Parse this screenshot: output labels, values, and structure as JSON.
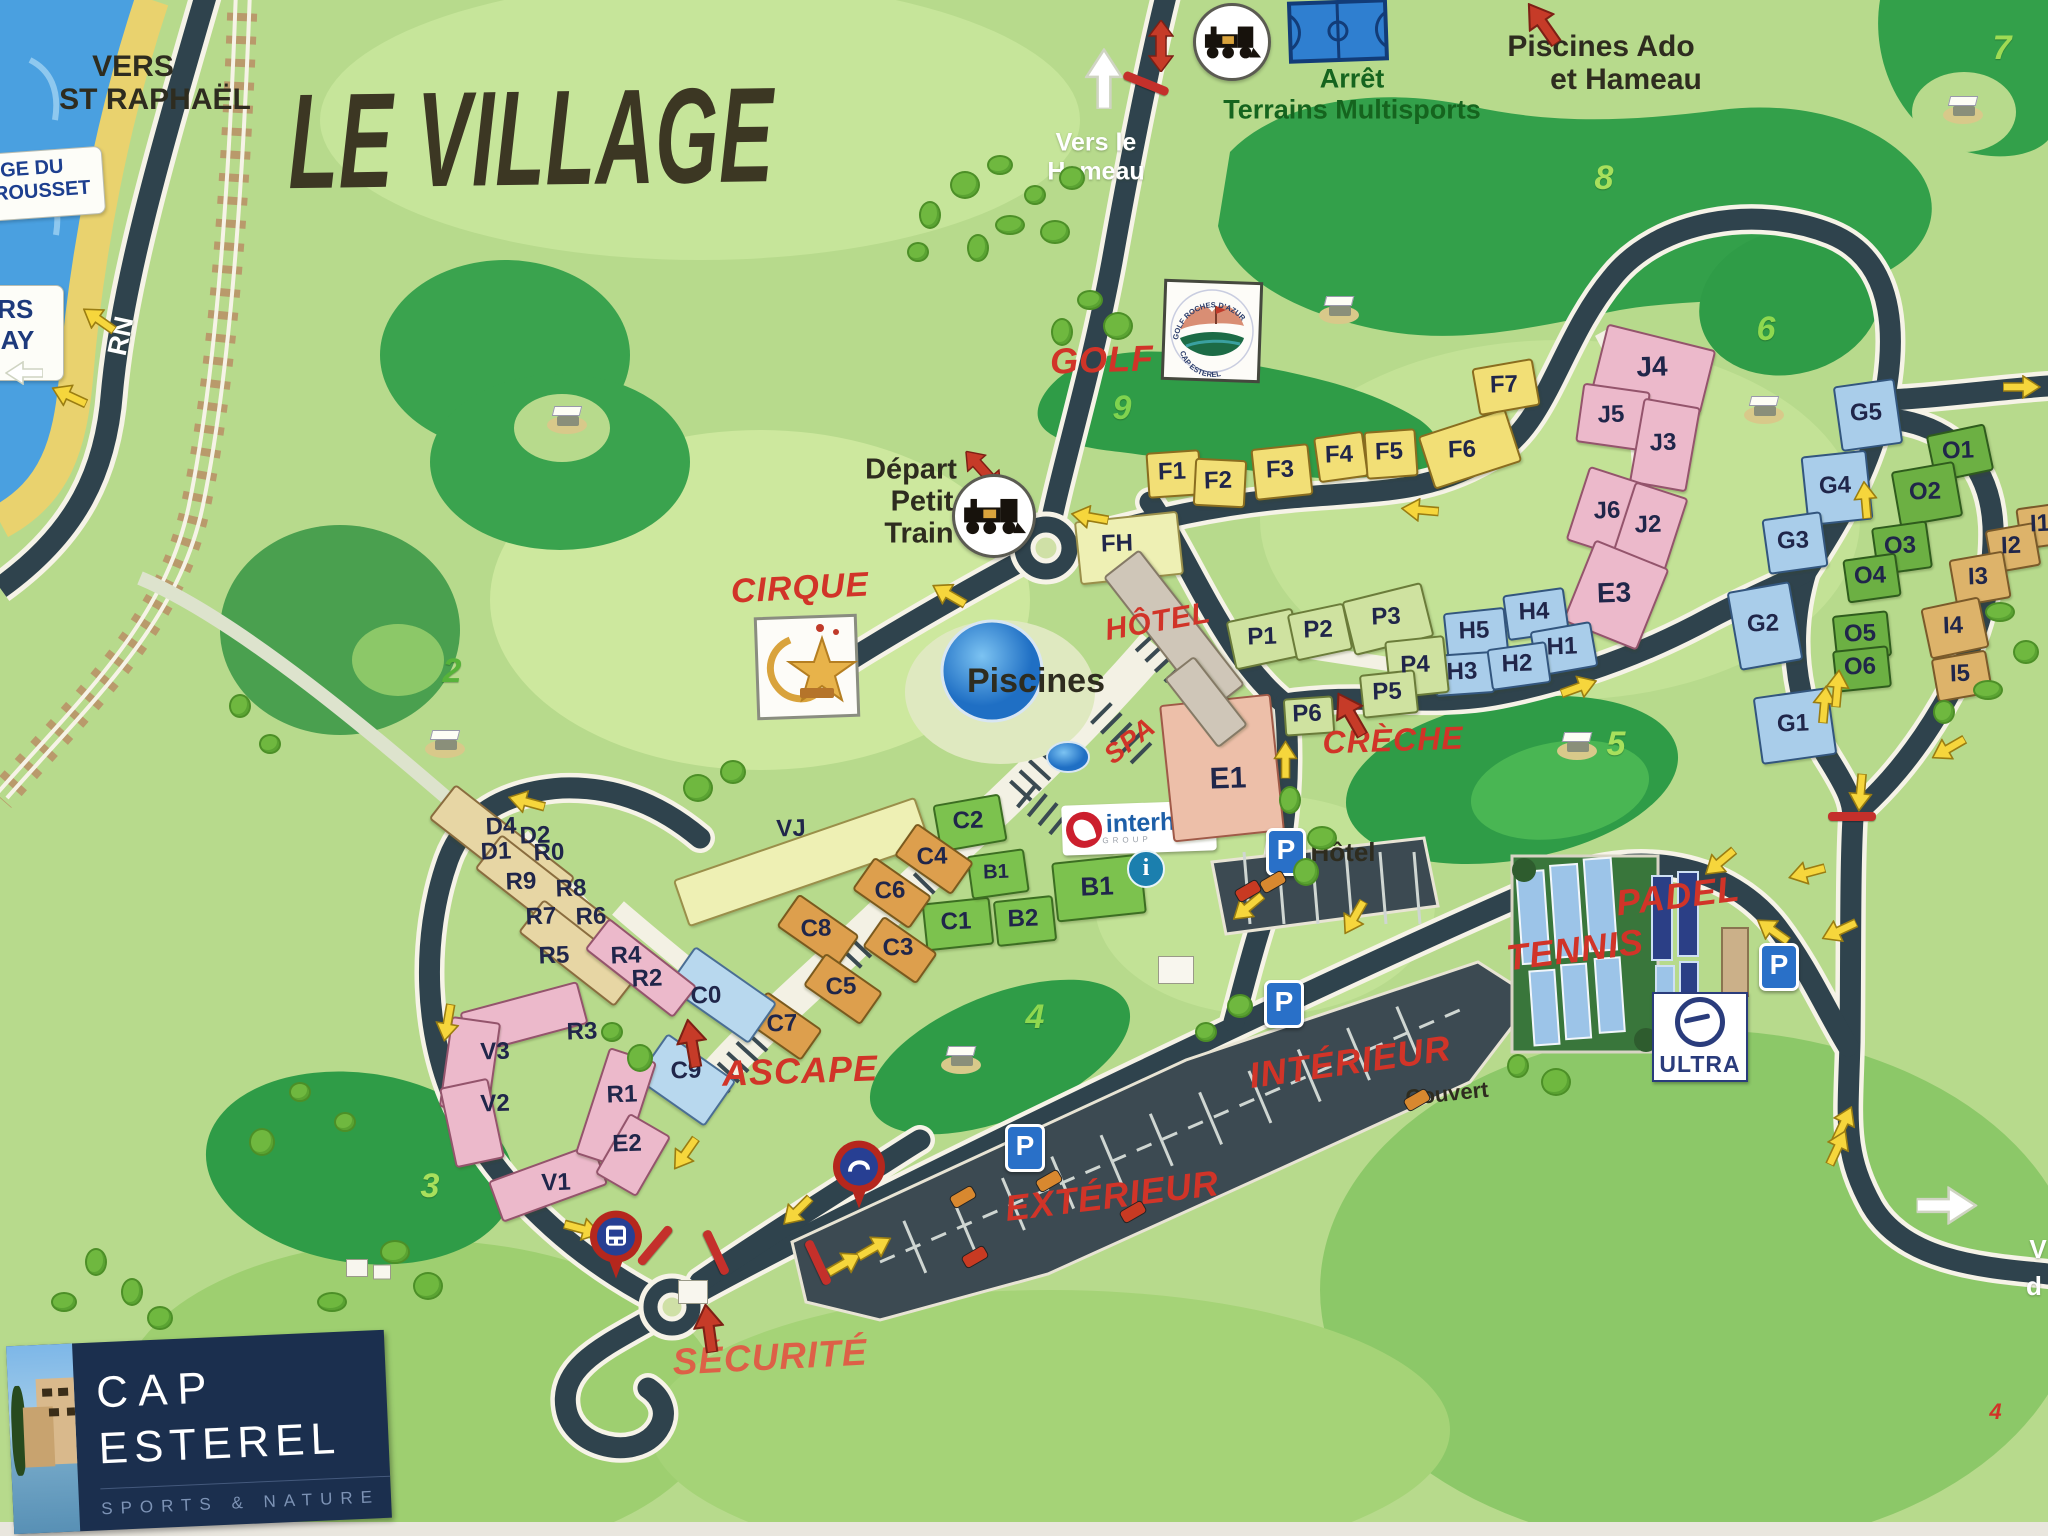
{
  "title": "LE VILLAGE",
  "cap_logo": {
    "l1": "CAP",
    "l2": "ESTEREL",
    "tag": "SPORTS & NATURE"
  },
  "signs": {
    "plage": {
      "l1": "PLAGE DU",
      "l2": "POURROUSSET"
    },
    "agay": {
      "l1": "VERS",
      "l2": "AGAY"
    }
  },
  "logos": {
    "interhome": {
      "text": "interhome",
      "sub": "GROUP"
    },
    "ultra": {
      "text": "ULTRA"
    },
    "golf_badge": {
      "top": "GOLF ROCHES D'AZUR",
      "bottom": "CAP ESTEREL"
    }
  },
  "red_labels": [
    {
      "t": "GOLF",
      "x": 1102,
      "y": 360,
      "s": 36,
      "r": -2
    },
    {
      "t": "CIRQUE",
      "x": 800,
      "y": 588,
      "s": 34,
      "r": -3
    },
    {
      "t": "HÔTEL",
      "x": 1158,
      "y": 622,
      "s": 30,
      "r": -10
    },
    {
      "t": "SPA",
      "x": 1130,
      "y": 741,
      "s": 27,
      "r": -38
    },
    {
      "t": "CRÈCHE",
      "x": 1393,
      "y": 740,
      "s": 32,
      "r": -2
    },
    {
      "t": "ASCAPE",
      "x": 800,
      "y": 1071,
      "s": 36,
      "r": -2
    },
    {
      "t": "TENNIS",
      "x": 1575,
      "y": 950,
      "s": 36,
      "r": -7
    },
    {
      "t": "PADEL",
      "x": 1678,
      "y": 896,
      "s": 36,
      "r": -7
    },
    {
      "t": "INTÉRIEUR",
      "x": 1350,
      "y": 1062,
      "s": 36,
      "r": -8
    },
    {
      "t": "EXTÉRIEUR",
      "x": 1112,
      "y": 1196,
      "s": 36,
      "r": -7
    },
    {
      "t": "SÉCURITÉ",
      "x": 770,
      "y": 1357,
      "s": 37,
      "r": -3,
      "c": "#dd6047"
    },
    {
      "t": "4",
      "x": 1996,
      "y": 1412,
      "s": 22,
      "r": 0
    }
  ],
  "dark_labels": [
    {
      "t": "VERS",
      "x": 133,
      "y": 67,
      "s": 30
    },
    {
      "t": "ST RAPHAËL",
      "x": 155,
      "y": 100,
      "s": 30
    },
    {
      "t": "Piscines Ado",
      "x": 1601,
      "y": 47,
      "s": 30
    },
    {
      "t": "et Hameau",
      "x": 1626,
      "y": 80,
      "s": 30
    },
    {
      "t": "Départ",
      "x": 911,
      "y": 470,
      "s": 29
    },
    {
      "t": "Petit",
      "x": 922,
      "y": 502,
      "s": 29
    },
    {
      "t": "Train",
      "x": 919,
      "y": 534,
      "s": 29
    },
    {
      "t": "Piscines",
      "x": 1036,
      "y": 681,
      "s": 34
    },
    {
      "t": "Hôtel",
      "x": 1343,
      "y": 852,
      "s": 26
    },
    {
      "t": "Couvert",
      "x": 1447,
      "y": 1094,
      "s": 22,
      "r": -6
    }
  ],
  "green_labels": [
    {
      "t": "Arrêt",
      "x": 1352,
      "y": 79,
      "s": 27
    },
    {
      "t": "Terrains Multisports",
      "x": 1352,
      "y": 110,
      "s": 27
    }
  ],
  "white_labels": [
    {
      "t": "Vers le",
      "x": 1096,
      "y": 143,
      "s": 25
    },
    {
      "t": "Hameau",
      "x": 1096,
      "y": 172,
      "s": 25
    },
    {
      "t": "RN",
      "x": 121,
      "y": 336,
      "s": 27,
      "r": -78
    },
    {
      "t": "V",
      "x": 2038,
      "y": 1249,
      "s": 26
    },
    {
      "t": "d",
      "x": 2034,
      "y": 1286,
      "s": 26
    }
  ],
  "zone_numbers": [
    {
      "n": "7",
      "x": 2002,
      "y": 48,
      "c": "#9fdb54"
    },
    {
      "n": "8",
      "x": 1604,
      "y": 178,
      "c": "#a8e05c"
    },
    {
      "n": "9",
      "x": 1122,
      "y": 408,
      "c": "#7fd34f"
    },
    {
      "n": "6",
      "x": 1766,
      "y": 329,
      "c": "#8fd84f"
    },
    {
      "n": "5",
      "x": 1616,
      "y": 744,
      "c": "#a8e05c"
    },
    {
      "n": "2",
      "x": 452,
      "y": 671,
      "c": "#57b33a"
    },
    {
      "n": "3",
      "x": 430,
      "y": 1186,
      "c": "#a8e05c"
    },
    {
      "n": "4",
      "x": 1035,
      "y": 1017,
      "c": "#8fd84f"
    }
  ],
  "buildings": [
    {
      "x": 1172,
      "y": 472,
      "w": 50,
      "h": 42,
      "r": -4,
      "p": "y"
    },
    {
      "x": 1218,
      "y": 481,
      "w": 48,
      "h": 44,
      "r": 3,
      "p": "y"
    },
    {
      "x": 1280,
      "y": 470,
      "w": 54,
      "h": 48,
      "r": -6,
      "p": "y"
    },
    {
      "x": 1339,
      "y": 455,
      "w": 46,
      "h": 42,
      "r": -8,
      "p": "y"
    },
    {
      "x": 1389,
      "y": 452,
      "w": 48,
      "h": 44,
      "r": -4,
      "p": "y"
    },
    {
      "x": 1468,
      "y": 447,
      "w": 88,
      "h": 52,
      "r": -18,
      "p": "y"
    },
    {
      "x": 1504,
      "y": 385,
      "w": 58,
      "h": 44,
      "r": -10,
      "p": "y"
    },
    {
      "x": 1127,
      "y": 546,
      "w": 100,
      "h": 60,
      "r": -6,
      "p": "py"
    },
    {
      "x": 800,
      "y": 860,
      "w": 252,
      "h": 46,
      "r": -19,
      "p": "py"
    },
    {
      "x": 1652,
      "y": 367,
      "w": 108,
      "h": 62,
      "r": 14,
      "p": "pk"
    },
    {
      "x": 1611,
      "y": 415,
      "w": 64,
      "h": 56,
      "r": 8,
      "p": "pk"
    },
    {
      "x": 1663,
      "y": 443,
      "w": 54,
      "h": 82,
      "r": 10,
      "p": "pk"
    },
    {
      "x": 1607,
      "y": 511,
      "w": 62,
      "h": 74,
      "r": 18,
      "p": "pk"
    },
    {
      "x": 1648,
      "y": 525,
      "w": 52,
      "h": 74,
      "r": 18,
      "p": "pk"
    },
    {
      "x": 1614,
      "y": 593,
      "w": 76,
      "h": 84,
      "r": 22,
      "p": "pk"
    },
    {
      "x": 1474,
      "y": 631,
      "w": 58,
      "h": 42,
      "r": -6,
      "p": "bl"
    },
    {
      "x": 1534,
      "y": 612,
      "w": 58,
      "h": 42,
      "r": -8,
      "p": "bl"
    },
    {
      "x": 1562,
      "y": 647,
      "w": 58,
      "h": 42,
      "r": -10,
      "p": "bl"
    },
    {
      "x": 1462,
      "y": 672,
      "w": 56,
      "h": 38,
      "r": -4,
      "p": "bl"
    },
    {
      "x": 1517,
      "y": 664,
      "w": 56,
      "h": 38,
      "r": -8,
      "p": "bl"
    },
    {
      "x": 1262,
      "y": 637,
      "w": 64,
      "h": 46,
      "r": -12,
      "p": "pg"
    },
    {
      "x": 1318,
      "y": 630,
      "w": 54,
      "h": 44,
      "r": -12,
      "p": "pg"
    },
    {
      "x": 1386,
      "y": 617,
      "w": 78,
      "h": 52,
      "r": -14,
      "p": "pg"
    },
    {
      "x": 1415,
      "y": 665,
      "w": 56,
      "h": 54,
      "r": -6,
      "p": "pg"
    },
    {
      "x": 1387,
      "y": 692,
      "w": 52,
      "h": 40,
      "r": -6,
      "p": "pg"
    },
    {
      "x": 1307,
      "y": 714,
      "w": 46,
      "h": 34,
      "r": -4,
      "p": "pg"
    },
    {
      "x": 1220,
      "y": 766,
      "w": 108,
      "h": 134,
      "r": -6,
      "p": "sal"
    },
    {
      "x": 968,
      "y": 821,
      "w": 64,
      "h": 44,
      "r": -10,
      "p": "gr"
    },
    {
      "x": 956,
      "y": 922,
      "w": 64,
      "h": 44,
      "r": -6,
      "p": "gr"
    },
    {
      "x": 1023,
      "y": 919,
      "w": 56,
      "h": 42,
      "r": -6,
      "p": "gr"
    },
    {
      "x": 996,
      "y": 872,
      "w": 54,
      "h": 40,
      "r": -8,
      "p": "gr"
    },
    {
      "x": 1097,
      "y": 886,
      "w": 86,
      "h": 56,
      "r": -6,
      "p": "gr"
    },
    {
      "x": 932,
      "y": 857,
      "w": 66,
      "h": 36,
      "r": 35,
      "p": "og"
    },
    {
      "x": 890,
      "y": 891,
      "w": 66,
      "h": 36,
      "r": 35,
      "p": "og"
    },
    {
      "x": 816,
      "y": 929,
      "w": 70,
      "h": 36,
      "r": 35,
      "p": "og"
    },
    {
      "x": 898,
      "y": 948,
      "w": 62,
      "h": 34,
      "r": 35,
      "p": "og"
    },
    {
      "x": 841,
      "y": 987,
      "w": 66,
      "h": 36,
      "r": 35,
      "p": "og"
    },
    {
      "x": 782,
      "y": 1024,
      "w": 64,
      "h": 34,
      "r": 35,
      "p": "og"
    },
    {
      "x": 720,
      "y": 993,
      "w": 96,
      "h": 46,
      "r": 35,
      "p": "lb"
    },
    {
      "x": 684,
      "y": 1078,
      "w": 80,
      "h": 52,
      "r": 35,
      "p": "lb"
    },
    {
      "x": 500,
      "y": 846,
      "w": 148,
      "h": 40,
      "r": 38,
      "p": "tan"
    },
    {
      "x": 546,
      "y": 896,
      "w": 148,
      "h": 40,
      "r": 38,
      "p": "tan"
    },
    {
      "x": 577,
      "y": 951,
      "w": 118,
      "h": 38,
      "r": 38,
      "p": "tan"
    },
    {
      "x": 639,
      "y": 966,
      "w": 108,
      "h": 36,
      "r": 38,
      "p": "pk"
    },
    {
      "x": 522,
      "y": 1016,
      "w": 118,
      "h": 40,
      "r": -15,
      "p": "pk"
    },
    {
      "x": 468,
      "y": 1063,
      "w": 46,
      "h": 88,
      "r": 8,
      "p": "pk"
    },
    {
      "x": 470,
      "y": 1121,
      "w": 46,
      "h": 78,
      "r": -12,
      "p": "pk"
    },
    {
      "x": 546,
      "y": 1181,
      "w": 108,
      "h": 40,
      "r": -20,
      "p": "pk"
    },
    {
      "x": 614,
      "y": 1106,
      "w": 46,
      "h": 108,
      "r": 18,
      "p": "pk"
    },
    {
      "x": 631,
      "y": 1153,
      "w": 44,
      "h": 66,
      "r": 30,
      "p": "pk"
    },
    {
      "x": 1172,
      "y": 629,
      "w": 42,
      "h": 168,
      "r": -38,
      "p": "gray"
    },
    {
      "x": 1204,
      "y": 700,
      "w": 34,
      "h": 84,
      "r": -38,
      "p": "gray"
    },
    {
      "x": 1866,
      "y": 413,
      "w": 58,
      "h": 62,
      "r": -8,
      "p": "bl"
    },
    {
      "x": 1835,
      "y": 486,
      "w": 62,
      "h": 66,
      "r": -6,
      "p": "bl"
    },
    {
      "x": 1793,
      "y": 541,
      "w": 56,
      "h": 52,
      "r": -8,
      "p": "bl"
    },
    {
      "x": 1763,
      "y": 624,
      "w": 60,
      "h": 76,
      "r": -10,
      "p": "bl"
    },
    {
      "x": 1793,
      "y": 724,
      "w": 72,
      "h": 64,
      "r": -8,
      "p": "bl"
    },
    {
      "x": 1958,
      "y": 451,
      "w": 56,
      "h": 44,
      "r": -12,
      "p": "dg"
    },
    {
      "x": 1925,
      "y": 492,
      "w": 60,
      "h": 52,
      "r": -10,
      "p": "dg"
    },
    {
      "x": 1900,
      "y": 546,
      "w": 52,
      "h": 44,
      "r": -8,
      "p": "dg"
    },
    {
      "x": 1870,
      "y": 576,
      "w": 50,
      "h": 40,
      "r": -8,
      "p": "dg"
    },
    {
      "x": 1860,
      "y": 634,
      "w": 52,
      "h": 42,
      "r": -6,
      "p": "dg"
    },
    {
      "x": 1860,
      "y": 667,
      "w": 52,
      "h": 38,
      "r": -6,
      "p": "dg"
    },
    {
      "x": 2040,
      "y": 524,
      "w": 44,
      "h": 38,
      "r": -8,
      "p": "or2"
    },
    {
      "x": 2011,
      "y": 546,
      "w": 46,
      "h": 40,
      "r": -10,
      "p": "or2"
    },
    {
      "x": 1978,
      "y": 577,
      "w": 52,
      "h": 44,
      "r": -10,
      "p": "or2"
    },
    {
      "x": 1953,
      "y": 626,
      "w": 56,
      "h": 48,
      "r": -12,
      "p": "or2"
    },
    {
      "x": 1960,
      "y": 674,
      "w": 52,
      "h": 40,
      "r": -10,
      "p": "or2"
    }
  ],
  "building_labels": [
    {
      "t": "F1",
      "x": 1172,
      "y": 472
    },
    {
      "t": "F2",
      "x": 1218,
      "y": 481
    },
    {
      "t": "F3",
      "x": 1280,
      "y": 470
    },
    {
      "t": "F4",
      "x": 1339,
      "y": 455
    },
    {
      "t": "F5",
      "x": 1389,
      "y": 452
    },
    {
      "t": "F6",
      "x": 1462,
      "y": 450
    },
    {
      "t": "F7",
      "x": 1504,
      "y": 385
    },
    {
      "t": "FH",
      "x": 1117,
      "y": 544
    },
    {
      "t": "VJ",
      "x": 791,
      "y": 829
    },
    {
      "t": "J4",
      "x": 1652,
      "y": 367,
      "s": 28
    },
    {
      "t": "J5",
      "x": 1611,
      "y": 415
    },
    {
      "t": "J3",
      "x": 1663,
      "y": 443
    },
    {
      "t": "J6",
      "x": 1607,
      "y": 511
    },
    {
      "t": "J2",
      "x": 1648,
      "y": 525
    },
    {
      "t": "E3",
      "x": 1614,
      "y": 593,
      "s": 28
    },
    {
      "t": "H5",
      "x": 1474,
      "y": 631
    },
    {
      "t": "H4",
      "x": 1534,
      "y": 612
    },
    {
      "t": "H1",
      "x": 1562,
      "y": 647
    },
    {
      "t": "H3",
      "x": 1462,
      "y": 672
    },
    {
      "t": "H2",
      "x": 1517,
      "y": 664
    },
    {
      "t": "P1",
      "x": 1262,
      "y": 637
    },
    {
      "t": "P2",
      "x": 1318,
      "y": 630
    },
    {
      "t": "P3",
      "x": 1386,
      "y": 617
    },
    {
      "t": "P4",
      "x": 1415,
      "y": 665
    },
    {
      "t": "P5",
      "x": 1387,
      "y": 692
    },
    {
      "t": "P6",
      "x": 1307,
      "y": 714
    },
    {
      "t": "E1",
      "x": 1228,
      "y": 779,
      "s": 30
    },
    {
      "t": "C2",
      "x": 968,
      "y": 821
    },
    {
      "t": "C1",
      "x": 956,
      "y": 922
    },
    {
      "t": "B2",
      "x": 1023,
      "y": 919
    },
    {
      "t": "B1",
      "x": 996,
      "y": 872,
      "s": 20
    },
    {
      "t": "B1",
      "x": 1097,
      "y": 886,
      "s": 26
    },
    {
      "t": "C4",
      "x": 932,
      "y": 857
    },
    {
      "t": "C6",
      "x": 890,
      "y": 891
    },
    {
      "t": "C8",
      "x": 816,
      "y": 929
    },
    {
      "t": "C3",
      "x": 898,
      "y": 948
    },
    {
      "t": "C5",
      "x": 841,
      "y": 987
    },
    {
      "t": "C7",
      "x": 782,
      "y": 1024
    },
    {
      "t": "C0",
      "x": 706,
      "y": 996
    },
    {
      "t": "C9",
      "x": 686,
      "y": 1071
    },
    {
      "t": "D4",
      "x": 501,
      "y": 827
    },
    {
      "t": "D2",
      "x": 535,
      "y": 836
    },
    {
      "t": "D1",
      "x": 496,
      "y": 852
    },
    {
      "t": "R0",
      "x": 549,
      "y": 853
    },
    {
      "t": "R9",
      "x": 521,
      "y": 882
    },
    {
      "t": "R8",
      "x": 571,
      "y": 889
    },
    {
      "t": "R7",
      "x": 541,
      "y": 917
    },
    {
      "t": "R6",
      "x": 591,
      "y": 917
    },
    {
      "t": "R5",
      "x": 554,
      "y": 956
    },
    {
      "t": "R4",
      "x": 626,
      "y": 956
    },
    {
      "t": "R2",
      "x": 647,
      "y": 979
    },
    {
      "t": "R3",
      "x": 582,
      "y": 1032
    },
    {
      "t": "V3",
      "x": 495,
      "y": 1052
    },
    {
      "t": "V2",
      "x": 495,
      "y": 1104
    },
    {
      "t": "R1",
      "x": 622,
      "y": 1095
    },
    {
      "t": "E2",
      "x": 627,
      "y": 1144
    },
    {
      "t": "V1",
      "x": 556,
      "y": 1183
    },
    {
      "t": "G5",
      "x": 1866,
      "y": 413
    },
    {
      "t": "G4",
      "x": 1835,
      "y": 486
    },
    {
      "t": "G3",
      "x": 1793,
      "y": 541
    },
    {
      "t": "G2",
      "x": 1763,
      "y": 624
    },
    {
      "t": "G1",
      "x": 1793,
      "y": 724
    },
    {
      "t": "O1",
      "x": 1958,
      "y": 451
    },
    {
      "t": "O2",
      "x": 1925,
      "y": 492
    },
    {
      "t": "O3",
      "x": 1900,
      "y": 546
    },
    {
      "t": "O4",
      "x": 1870,
      "y": 576
    },
    {
      "t": "O5",
      "x": 1860,
      "y": 634
    },
    {
      "t": "O6",
      "x": 1860,
      "y": 667
    },
    {
      "t": "I1",
      "x": 2040,
      "y": 524
    },
    {
      "t": "I2",
      "x": 2011,
      "y": 546
    },
    {
      "t": "I3",
      "x": 1978,
      "y": 577
    },
    {
      "t": "I4",
      "x": 1953,
      "y": 626
    },
    {
      "t": "I5",
      "x": 1960,
      "y": 674
    }
  ],
  "yellow_arrows": [
    {
      "x": 1090,
      "y": 512,
      "r": 190
    },
    {
      "x": 950,
      "y": 590,
      "r": 210
    },
    {
      "x": 1420,
      "y": 505,
      "r": 185
    },
    {
      "x": 527,
      "y": 797,
      "r": 195
    },
    {
      "x": 445,
      "y": 1020,
      "r": 100
    },
    {
      "x": 683,
      "y": 1150,
      "r": 125
    },
    {
      "x": 795,
      "y": 1207,
      "r": 135
    },
    {
      "x": 846,
      "y": 1263,
      "r": -30
    },
    {
      "x": 876,
      "y": 1247,
      "r": -30
    },
    {
      "x": 1288,
      "y": 757,
      "r": -90
    },
    {
      "x": 1246,
      "y": 903,
      "r": 140
    },
    {
      "x": 1352,
      "y": 914,
      "r": 120
    },
    {
      "x": 1580,
      "y": 687,
      "r": -20
    },
    {
      "x": 1718,
      "y": 858,
      "r": 140
    },
    {
      "x": 1806,
      "y": 868,
      "r": 165
    },
    {
      "x": 1774,
      "y": 926,
      "r": 215
    },
    {
      "x": 1838,
      "y": 926,
      "r": 155
    },
    {
      "x": 1846,
      "y": 1122,
      "r": -65
    },
    {
      "x": 1840,
      "y": 1146,
      "r": -65
    },
    {
      "x": 1868,
      "y": 497,
      "r": -95
    },
    {
      "x": 1827,
      "y": 702,
      "r": -85
    },
    {
      "x": 1840,
      "y": 686,
      "r": -85
    },
    {
      "x": 1947,
      "y": 744,
      "r": 150
    },
    {
      "x": 1858,
      "y": 790,
      "r": 95
    },
    {
      "x": 2022,
      "y": 387,
      "r": 0
    },
    {
      "x": 70,
      "y": 391,
      "r": 205
    },
    {
      "x": 100,
      "y": 315,
      "r": 215
    },
    {
      "x": 582,
      "y": 1229,
      "r": 15
    }
  ],
  "red_arrows": [
    {
      "x": 1358,
      "y": 713,
      "r": -30
    },
    {
      "x": 700,
      "y": 1043,
      "r": -10
    },
    {
      "x": 717,
      "y": 1328,
      "r": -8
    },
    {
      "x": 1550,
      "y": 22,
      "r": -35
    }
  ],
  "red_double_arrows": [
    {
      "x": 1160,
      "y": 22,
      "r": 0
    },
    {
      "x": 984,
      "y": 446,
      "r": -42
    }
  ],
  "barriers": [
    {
      "x": 1146,
      "y": 84,
      "r": 22
    },
    {
      "x": 1852,
      "y": 817,
      "r": 0
    },
    {
      "x": 655,
      "y": 1246,
      "r": -50
    },
    {
      "x": 716,
      "y": 1253,
      "r": 65
    },
    {
      "x": 818,
      "y": 1263,
      "r": 65
    }
  ],
  "white_arrows": [
    {
      "x": 1108,
      "y": 76,
      "r": -90,
      "sc": 1.6
    },
    {
      "x": 1947,
      "y": 1207,
      "r": 0,
      "sc": 1.6
    },
    {
      "x": 24,
      "y": 368,
      "r": 180,
      "sc": 1
    }
  ],
  "golf_carts": [
    {
      "x": 568,
      "y": 418
    },
    {
      "x": 446,
      "y": 742
    },
    {
      "x": 1340,
      "y": 308
    },
    {
      "x": 1765,
      "y": 408
    },
    {
      "x": 1578,
      "y": 744
    },
    {
      "x": 962,
      "y": 1058
    },
    {
      "x": 1964,
      "y": 108
    }
  ],
  "train_stops": [
    {
      "x": 1232,
      "y": 42,
      "d": 72
    },
    {
      "x": 994,
      "y": 516,
      "d": 78
    }
  ],
  "p_signs": [
    {
      "x": 1286,
      "y": 852
    },
    {
      "x": 1025,
      "y": 1148
    },
    {
      "x": 1284,
      "y": 1004
    },
    {
      "x": 1779,
      "y": 967
    }
  ],
  "info_icon": {
    "x": 1146,
    "y": 869
  },
  "bus_pin": {
    "x": 617,
    "y": 1275
  },
  "gate_pin": {
    "x": 860,
    "y": 1205
  },
  "court_icon": {
    "x": 1338,
    "y": 30
  }
}
